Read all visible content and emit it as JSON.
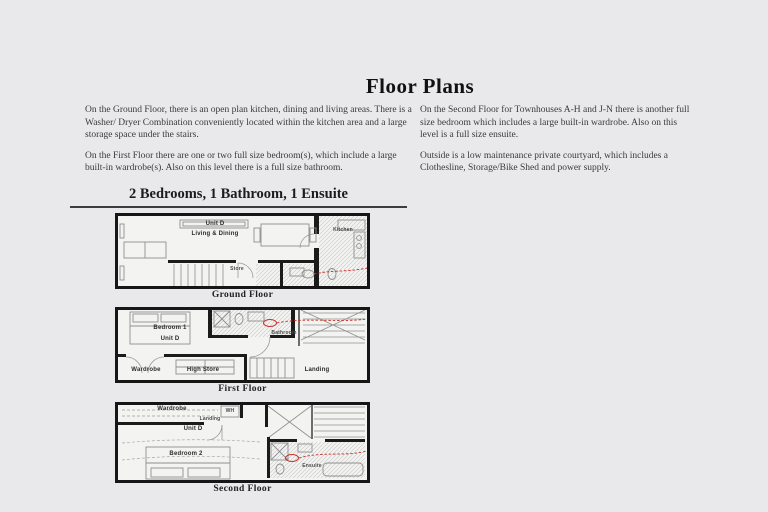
{
  "title": "Floor Plans",
  "intro": {
    "left": {
      "para1": "On the Ground Floor, there is an open plan kitchen, dining and living areas. There is a Washer/ Dryer Combination conveniently located within the kitchen area and a large storage space under the stairs.",
      "para2": "On the First Floor there are one or two full size bedroom(s), which include a large built-in wardrobe(s). Also on this level there is a full size bathroom."
    },
    "right": {
      "para1": "On the Second Floor for Townhouses A-H and J-N there is another full size bedroom which includes a large built-in wardrobe. Also on this level is a full size ensuite.",
      "para2": "Outside is a low maintenance private courtyard, which includes a Clothesline, Storage/Bike Shed and power supply."
    }
  },
  "section_heading": "2 Bedrooms, 1 Bathroom, 1 Ensuite",
  "floors": {
    "ground": {
      "caption": "Ground Floor",
      "labels": {
        "unit": "Unit D",
        "room": "Living & Dining",
        "kitchen": "Kitchen",
        "store": "Store"
      }
    },
    "first": {
      "caption": "First Floor",
      "labels": {
        "bedroom": "Bedroom 1",
        "unit": "Unit D",
        "bathroom": "Bathroom",
        "wardrobe": "Wardrobe",
        "high_store": "High Store",
        "landing": "Landing"
      }
    },
    "second": {
      "caption": "Second Floor",
      "labels": {
        "wardrobe": "Wardrobe",
        "landing": "Landing",
        "wh": "WH",
        "unit": "Unit D",
        "bedroom": "Bedroom 2",
        "ensuite": "Ensuite"
      }
    }
  },
  "colors": {
    "background": "#e9e9eb",
    "wall": "#1b1b1b",
    "annotation_red": "#c93028"
  }
}
